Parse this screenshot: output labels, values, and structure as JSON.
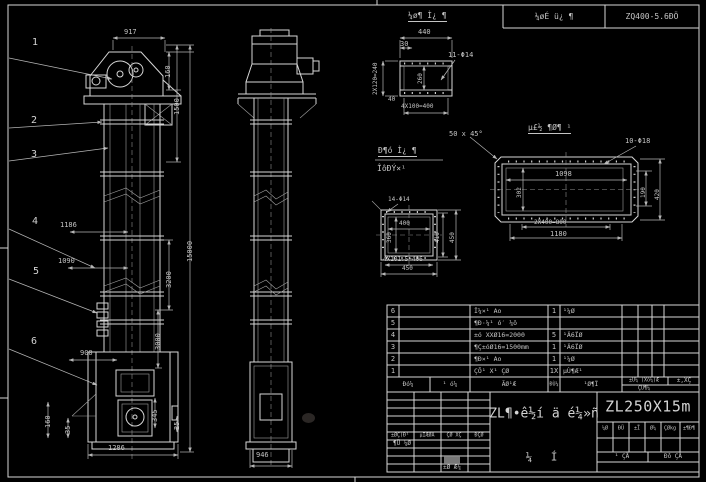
{
  "top_header": {
    "project": "¼øÉ ü¿ ¶",
    "model": "ZQ400-5.6ÐÖ"
  },
  "labels": [
    {
      "text": "917",
      "x": 124,
      "y": 29
    },
    {
      "text": "1186",
      "x": 60,
      "y": 222
    },
    {
      "text": "1090",
      "x": 58,
      "y": 258
    },
    {
      "text": "900",
      "x": 80,
      "y": 350
    },
    {
      "text": "1286",
      "x": 108,
      "y": 445
    },
    {
      "text": "946",
      "x": 256,
      "y": 452
    },
    {
      "text": "160",
      "x": 165,
      "y": 78,
      "rot": 1
    },
    {
      "text": "1500",
      "x": 174,
      "y": 115,
      "rot": 1
    },
    {
      "text": "15000",
      "x": 187,
      "y": 262,
      "rot": 1
    },
    {
      "text": "3200",
      "x": 166,
      "y": 288,
      "rot": 1
    },
    {
      "text": "3000",
      "x": 155,
      "y": 350,
      "rot": 1
    },
    {
      "text": "160",
      "x": 45,
      "y": 428,
      "rot": 1
    },
    {
      "text": "35",
      "x": 65,
      "y": 434,
      "rot": 1
    },
    {
      "text": "345",
      "x": 152,
      "y": 422,
      "rot": 1
    },
    {
      "text": "25",
      "x": 174,
      "y": 430,
      "rot": 1
    },
    {
      "text": "¼ø¶ Ì¿ ¶",
      "x": 408,
      "y": 12,
      "size": 8,
      "cls": "utitle"
    },
    {
      "text": "440",
      "x": 418,
      "y": 29
    },
    {
      "text": "30",
      "x": 400,
      "y": 41
    },
    {
      "text": "11-Φ14",
      "x": 448,
      "y": 52
    },
    {
      "text": "2X120=240",
      "x": 373,
      "y": 95,
      "rot": 1,
      "size": 6
    },
    {
      "text": "260",
      "x": 418,
      "y": 84,
      "rot": 1,
      "size": 6
    },
    {
      "text": "40",
      "x": 388,
      "y": 97,
      "size": 6
    },
    {
      "text": "4X100=400",
      "x": 401,
      "y": 104,
      "size": 6
    },
    {
      "text": "Ð¶ó Ì¿ ¶",
      "x": 378,
      "y": 147,
      "size": 8,
      "cls": "utitle"
    },
    {
      "text": "ÎôÐÝ×¹",
      "x": 377,
      "y": 165,
      "size": 8
    },
    {
      "text": "50 x 45°",
      "x": 449,
      "y": 131,
      "size": 7
    },
    {
      "text": "µ£½ ¶Ø¶ ¹",
      "x": 528,
      "y": 124,
      "size": 8,
      "cls": "utitle"
    },
    {
      "text": "10-Φ18",
      "x": 625,
      "y": 138
    },
    {
      "text": "1098",
      "x": 555,
      "y": 171
    },
    {
      "text": "302",
      "x": 517,
      "y": 198,
      "rot": 1,
      "size": 6
    },
    {
      "text": "190",
      "x": 641,
      "y": 198,
      "rot": 1,
      "size": 6
    },
    {
      "text": "420",
      "x": 655,
      "y": 200,
      "rot": 1,
      "size": 6
    },
    {
      "text": "2X400=800",
      "x": 534,
      "y": 220,
      "size": 6
    },
    {
      "text": "1180",
      "x": 550,
      "y": 231
    },
    {
      "text": "14-Φ14",
      "x": 388,
      "y": 197,
      "size": 6
    },
    {
      "text": "400",
      "x": 399,
      "y": 221,
      "size": 6
    },
    {
      "text": "360",
      "x": 387,
      "y": 243,
      "rot": 1,
      "size": 6
    },
    {
      "text": "410",
      "x": 435,
      "y": 243,
      "rot": 1,
      "size": 6
    },
    {
      "text": "450",
      "x": 450,
      "y": 243,
      "rot": 1,
      "size": 6
    },
    {
      "text": "4X101.5=406",
      "x": 383,
      "y": 257,
      "size": 6
    },
    {
      "text": "450",
      "x": 402,
      "y": 266,
      "size": 6
    }
  ],
  "balloons": [
    {
      "n": "1",
      "x": 32,
      "y": 38
    },
    {
      "n": "2",
      "x": 31,
      "y": 116
    },
    {
      "n": "3",
      "x": 31,
      "y": 150
    },
    {
      "n": "4",
      "x": 32,
      "y": 217
    },
    {
      "n": "5",
      "x": 33,
      "y": 267
    },
    {
      "n": "6",
      "x": 31,
      "y": 337
    }
  ],
  "parts_table": {
    "headers": [
      "Ðó¼",
      "¹ ó¼",
      "ÃØ¹Æ",
      "ÐÙ¼",
      "¹Ø¶Ï"
    ],
    "header_right_top_left": "±Ü¼ (Xó¼)Æ",
    "header_right_top_right": "±,XÇ",
    "header_right_bottom": "ÇÙ¶¼",
    "rows": [
      {
        "no": "6",
        "name": "Î¼×¹ Ao",
        "qty": "1",
        "material": "¹¼Ø"
      },
      {
        "no": "5",
        "name": "¶Ð·¼¹ ó′ ¼ô",
        "qty": "",
        "material": ""
      },
      {
        "no": "4",
        "name": "±ó XXØ16=2000",
        "qty": "5",
        "material": "¹Ä6ÏØ"
      },
      {
        "no": "3",
        "name": "¶Ç±óØ16=1500mm",
        "qty": "1",
        "material": "¹Ä6ÏØ"
      },
      {
        "no": "2",
        "name": "¶Ð×¹ Ao",
        "qty": "1",
        "material": "¹¼Ø"
      },
      {
        "no": "1",
        "name": "ÇÕ¹ X¹ ÇØ",
        "qty": "1X",
        "material": "µÙ¶Æ¹"
      }
    ]
  },
  "title_block": {
    "model": "ZL250X15m",
    "drawing_name": "ZL¶•ê½í ä é¼»ñ",
    "stamp_glyphs": [
      "¼",
      "Í"
    ],
    "sig_headers": [
      "±ØÇ(Ð¹",
      "µÏÆØÅ",
      "ÇØ XÇ",
      "ÐÇØ"
    ],
    "sig_row_label": "¶Ü ¼Ø",
    "sig_bottom_label": "±Ø Æ¼",
    "spec_headers": [
      "¼Ø",
      "ÐÜ",
      "±Ï",
      "Ø¼",
      "ÇØkg",
      "±¶Ð¶"
    ],
    "sheet_labels": [
      "¹ ÇÅ",
      "Ðô ÇÅ"
    ]
  }
}
